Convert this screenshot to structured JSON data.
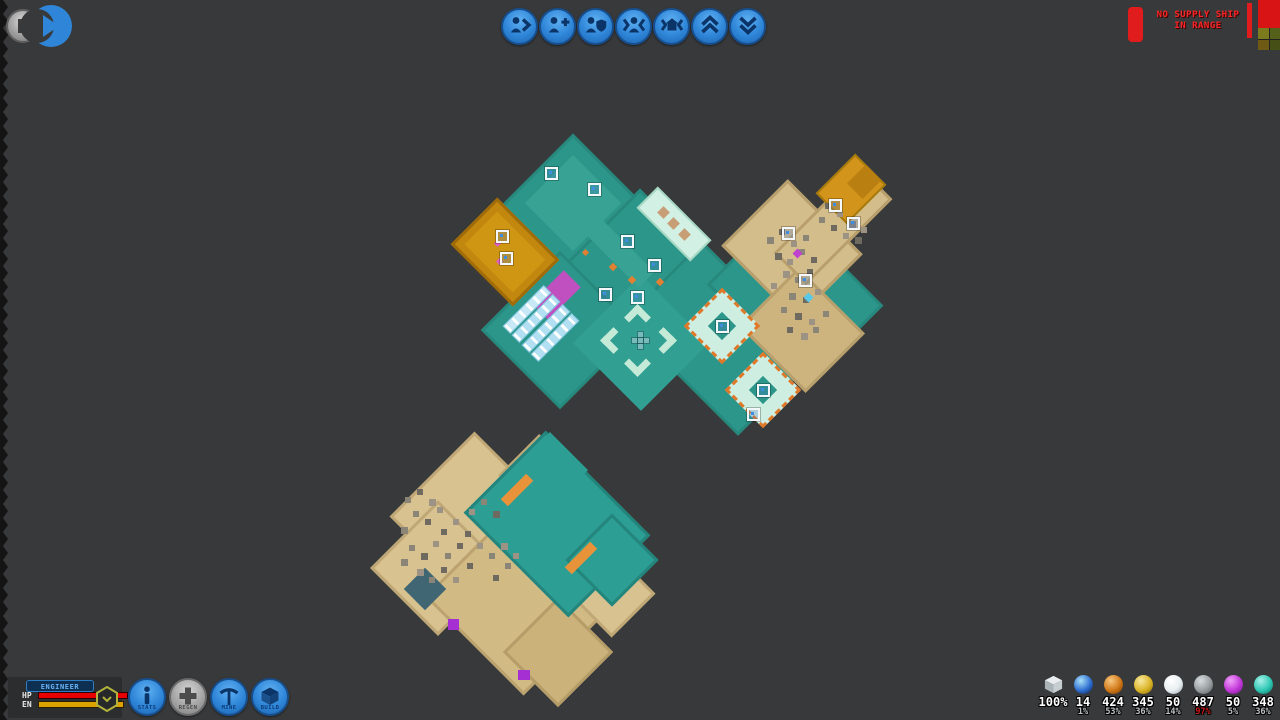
{
  "topbar": {
    "buttons": [
      {
        "name": "next-unit-button",
        "icon": "person-next"
      },
      {
        "name": "add-unit-button",
        "icon": "person-plus"
      },
      {
        "name": "guard-unit-button",
        "icon": "person-shield"
      },
      {
        "name": "focus-unit-button",
        "icon": "person-focus"
      },
      {
        "name": "focus-home-button",
        "icon": "home-focus"
      },
      {
        "name": "layer-up-button",
        "icon": "double-chevron-up"
      },
      {
        "name": "layer-down-button",
        "icon": "double-chevron-down"
      }
    ],
    "warning": {
      "line1": "NO SUPPLY SHIP",
      "line2": "IN RANGE",
      "color": "#ff2424"
    }
  },
  "character": {
    "name": "ENGINEER",
    "hp_label": "HP",
    "en_label": "EN",
    "hp_color": "#e60000",
    "en_color": "#dca200"
  },
  "action_buttons": [
    {
      "label": "STATS",
      "icon": "info",
      "style": "blue",
      "name": "stats-button"
    },
    {
      "label": "REGEN",
      "icon": "plus",
      "style": "gray",
      "name": "regen-button"
    },
    {
      "label": "MINE",
      "icon": "pickaxe",
      "style": "blue",
      "name": "mine-button"
    },
    {
      "label": "BUILD",
      "icon": "cube",
      "style": "blue",
      "name": "build-button"
    }
  ],
  "resources": [
    {
      "icon": "cube-icon",
      "value": "100%",
      "pct": ""
    },
    {
      "icon": "orb-icon",
      "colors": [
        "#a8e0f8",
        "#2f6fd0",
        "#0c2050"
      ],
      "value": "14",
      "pct": "1%"
    },
    {
      "icon": "orb-icon",
      "colors": [
        "#f8c880",
        "#d07818",
        "#7a3c04"
      ],
      "value": "424",
      "pct": "53%"
    },
    {
      "icon": "orb-icon",
      "colors": [
        "#f8e8a0",
        "#dab428",
        "#8a6a08"
      ],
      "value": "345",
      "pct": "36%"
    },
    {
      "icon": "orb-icon",
      "colors": [
        "#ffffff",
        "#e8eef0",
        "#9aa8b0"
      ],
      "value": "50",
      "pct": "14%"
    },
    {
      "icon": "orb-icon",
      "colors": [
        "#d8dcde",
        "#989ea0",
        "#5a6062"
      ],
      "value": "487",
      "pct": "97%",
      "pct_color": "#cc1616"
    },
    {
      "icon": "orb-icon",
      "colors": [
        "#f0a0f8",
        "#c238d8",
        "#701888"
      ],
      "value": "50",
      "pct": "5%"
    },
    {
      "icon": "orb-icon",
      "colors": [
        "#a8f0e8",
        "#2ec8b4",
        "#0c7060"
      ],
      "value": "348",
      "pct": "36%"
    }
  ],
  "map": {
    "shapes": [
      [
        573,
        207,
        104,
        104,
        45,
        "#2d968a",
        "3px solid #27897e"
      ],
      [
        640,
        272,
        118,
        118,
        45,
        "#2d968a",
        "3px solid #27897e"
      ],
      [
        560,
        330,
        112,
        112,
        45,
        "#2d968a",
        "3px solid #27897e"
      ],
      [
        702,
        300,
        84,
        84,
        45,
        "#2d968a",
        "3px solid #27897e"
      ],
      [
        738,
        365,
        100,
        100,
        45,
        "#2d968a",
        "3px solid #27897e"
      ],
      [
        795,
        295,
        140,
        110,
        45,
        "#2d968a",
        "3px solid #27897e"
      ],
      [
        641,
        343,
        96,
        96,
        45,
        "#31a092",
        ""
      ],
      [
        573,
        203,
        68,
        68,
        45,
        "#38a294",
        ""
      ],
      [
        607,
        240,
        112,
        22,
        45,
        "#38a294",
        ""
      ],
      [
        505,
        252,
        88,
        66,
        45,
        "#c2870f",
        "3px solid #a06c08"
      ],
      [
        505,
        252,
        68,
        46,
        45,
        "#cf9614",
        ""
      ],
      [
        674,
        224,
        76,
        30,
        45,
        "#d2f0e4",
        "2px solid #a6d8c4"
      ],
      [
        792,
        250,
        106,
        94,
        45,
        "#d3bd8b",
        "3px solid #b89f6c"
      ],
      [
        802,
        330,
        94,
        84,
        45,
        "#cdb47e",
        "3px solid #b89f6c"
      ],
      [
        833,
        226,
        122,
        46,
        -45,
        "#d3bd8b",
        "3px solid #b89f6c"
      ],
      [
        851,
        189,
        56,
        44,
        -45,
        "#d2941a",
        "2px solid #a87a0c"
      ],
      [
        864,
        182,
        26,
        22,
        -45,
        "#b97f10",
        ""
      ],
      [
        722,
        326,
        54,
        54,
        45,
        "#cfeee2",
        "3px dashed #e07828"
      ],
      [
        763,
        390,
        54,
        54,
        45,
        "#cfeee2",
        "3px dashed #e07828"
      ],
      [
        722,
        326,
        20,
        20,
        45,
        "#2d968a",
        ""
      ],
      [
        763,
        390,
        20,
        20,
        45,
        "#2d968a",
        ""
      ],
      [
        556,
        295,
        46,
        24,
        -45,
        "#c04fc0",
        ""
      ],
      [
        478,
        520,
        130,
        120,
        45,
        "#d8c28f",
        "3px solid #c0a876"
      ],
      [
        438,
        568,
        96,
        96,
        45,
        "#d8c28f",
        "3px solid #c0a876"
      ],
      [
        520,
        600,
        140,
        130,
        45,
        "#d2ba84",
        "3px solid #bca26f"
      ],
      [
        558,
        652,
        78,
        78,
        45,
        "#cbb27a",
        "3px solid #b59c68"
      ],
      [
        542,
        478,
        66,
        58,
        45,
        "#d8c28f",
        "3px solid #c0a876"
      ],
      [
        601,
        583,
        92,
        62,
        45,
        "#d8c28f",
        "3px solid #c0a876"
      ],
      [
        557,
        524,
        148,
        116,
        45,
        "#2d9e94",
        "3px solid #23857c"
      ],
      [
        612,
        560,
        66,
        66,
        45,
        "#2d9e94",
        "3px solid #23857c"
      ],
      [
        552,
        468,
        54,
        48,
        45,
        "#2d9e94",
        ""
      ],
      [
        517,
        490,
        36,
        10,
        -45,
        "#e8923a",
        ""
      ],
      [
        581,
        558,
        36,
        10,
        -45,
        "#e8923a",
        ""
      ],
      [
        425,
        589,
        30,
        30,
        45,
        "#3f6672",
        ""
      ],
      [
        453,
        624,
        11,
        11,
        0,
        "#a62fd4",
        ""
      ],
      [
        524,
        675,
        12,
        10,
        0,
        "#a62fd4",
        ""
      ]
    ],
    "conveyors": [
      [
        527,
        309,
        58,
        11,
        -45,
        "#e2f6fc"
      ],
      [
        536,
        318,
        58,
        11,
        -45,
        "#c6eaf6"
      ],
      [
        546,
        328,
        58,
        11,
        -45,
        "#c6eaf6"
      ],
      [
        555,
        337,
        58,
        11,
        -45,
        "#c6eaf6"
      ]
    ],
    "speckles": [
      [
        770,
        240
      ],
      [
        782,
        232
      ],
      [
        794,
        244
      ],
      [
        806,
        238
      ],
      [
        778,
        256
      ],
      [
        790,
        262
      ],
      [
        802,
        252
      ],
      [
        814,
        260
      ],
      [
        786,
        274
      ],
      [
        798,
        280
      ],
      [
        810,
        272
      ],
      [
        774,
        286
      ],
      [
        792,
        296
      ],
      [
        806,
        300
      ],
      [
        818,
        292
      ],
      [
        784,
        310
      ],
      [
        798,
        316
      ],
      [
        812,
        322
      ],
      [
        826,
        314
      ],
      [
        790,
        330
      ],
      [
        804,
        336
      ],
      [
        816,
        330
      ],
      [
        828,
        206
      ],
      [
        840,
        214
      ],
      [
        852,
        224
      ],
      [
        834,
        228
      ],
      [
        846,
        236
      ],
      [
        822,
        220
      ],
      [
        858,
        240
      ],
      [
        864,
        230
      ],
      [
        408,
        500
      ],
      [
        420,
        492
      ],
      [
        432,
        502
      ],
      [
        416,
        514
      ],
      [
        428,
        522
      ],
      [
        440,
        510
      ],
      [
        404,
        530
      ],
      [
        444,
        532
      ],
      [
        456,
        522
      ],
      [
        412,
        548
      ],
      [
        424,
        556
      ],
      [
        436,
        544
      ],
      [
        448,
        556
      ],
      [
        460,
        546
      ],
      [
        420,
        572
      ],
      [
        432,
        580
      ],
      [
        444,
        570
      ],
      [
        456,
        580
      ],
      [
        404,
        562
      ],
      [
        468,
        534
      ],
      [
        472,
        512
      ],
      [
        484,
        502
      ],
      [
        496,
        514
      ],
      [
        480,
        546
      ],
      [
        492,
        556
      ],
      [
        470,
        566
      ],
      [
        504,
        546
      ],
      [
        508,
        566
      ],
      [
        496,
        578
      ],
      [
        516,
        556
      ]
    ],
    "dots": [
      [
        663,
        212,
        9,
        "#c79e76"
      ],
      [
        673,
        223,
        9,
        "#c79e76"
      ],
      [
        684,
        234,
        9,
        "#c79e76"
      ],
      [
        613,
        267,
        6,
        "#e08030"
      ],
      [
        585,
        252,
        5,
        "#e08030"
      ],
      [
        632,
        280,
        6,
        "#e08030"
      ],
      [
        660,
        282,
        6,
        "#e08030"
      ],
      [
        797,
        253,
        7,
        "#c040d0"
      ],
      [
        808,
        297,
        7,
        "#59c8e8"
      ],
      [
        497,
        243,
        5,
        "#e060c0"
      ],
      [
        499,
        261,
        5,
        "#e060c0"
      ]
    ],
    "markers": [
      [
        551,
        173
      ],
      [
        594,
        189
      ],
      [
        627,
        241
      ],
      [
        654,
        265
      ],
      [
        605,
        294
      ],
      [
        637,
        297
      ],
      [
        502,
        236
      ],
      [
        506,
        258
      ],
      [
        835,
        205
      ],
      [
        853,
        223
      ],
      [
        788,
        233
      ],
      [
        805,
        280
      ],
      [
        722,
        326
      ],
      [
        763,
        390
      ],
      [
        753,
        414
      ]
    ],
    "chevrons": [
      [
        637,
        317,
        "up"
      ],
      [
        613,
        340,
        "left"
      ],
      [
        663,
        340,
        "right"
      ],
      [
        637,
        363,
        "down"
      ]
    ],
    "cursor": [
      640,
      340
    ]
  }
}
